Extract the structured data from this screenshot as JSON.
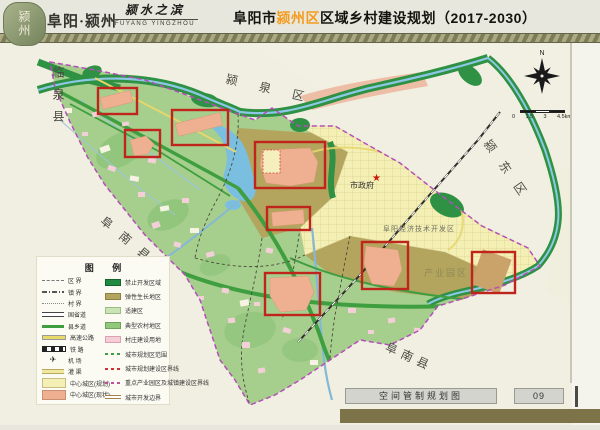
{
  "header": {
    "seal": "颍州",
    "brand": "阜阳·颍州",
    "slogan": "颍水之滨",
    "slogan_en": "FUYANG YINGZHOU",
    "title_prefix": "阜阳市",
    "title_highlight": "颍州区",
    "title_suffix": "区域乡村建设规划（2017-2030）",
    "highlight_color": "#f49c20"
  },
  "map": {
    "labels": {
      "linquan_county": "临泉县",
      "yingquan_district": "颍泉区",
      "yingdong_district": "颍东区",
      "funan_county_west": "阜南县",
      "funan_county_south": "阜南县",
      "city_government": "市政府",
      "dev_zone": "阜阳经济技术开发区",
      "industrial_park": "产业园区"
    },
    "compass_north": "N",
    "scale_labels": [
      "0",
      "1.5",
      "3",
      "4.5km"
    ],
    "colors": {
      "highlight_box": "#c0251c",
      "district_fill": "#a6cf8e",
      "forbidden_green": "#2e9143",
      "elastic_olive": "#b3a45e",
      "city_yellow": "#f4efb4",
      "built_salmon": "#eeb090",
      "water_blue": "#8cc8e6",
      "boundary_purple": "#b44fb8"
    }
  },
  "legend": {
    "title": "图 例",
    "left": [
      {
        "label": "区  界"
      },
      {
        "label": "镇  界"
      },
      {
        "label": "村  界"
      },
      {
        "label": "国省道"
      },
      {
        "label": "县乡道"
      },
      {
        "label": "高速公路"
      },
      {
        "label": "铁  路"
      },
      {
        "label": "机  场"
      },
      {
        "label": "灌  渠"
      },
      {
        "label": "中心城区(规划)"
      },
      {
        "label": "中心城区(现状)"
      }
    ],
    "right": [
      {
        "label": "禁止开发区域",
        "color": "#1f8a40"
      },
      {
        "label": "弹性生长地区",
        "color": "#b3a45e"
      },
      {
        "label": "适建区",
        "color": "#cbe4b6"
      },
      {
        "label": "典型农村地区",
        "color": "#92c87c"
      },
      {
        "label": "村庄建设用地",
        "color": "#f4cdd6"
      },
      {
        "label": "城市规划区范围",
        "color": "#3f9e3f"
      },
      {
        "label": "城市规划建设区界线",
        "color": "#d03030"
      },
      {
        "label": "重点产业园区及城镇建设区界线",
        "color": "#c050a0"
      },
      {
        "label": "城市开发边界",
        "color": "#b89868"
      }
    ]
  },
  "footer": {
    "map_name": "空间管制规划图",
    "page_number": "09"
  }
}
